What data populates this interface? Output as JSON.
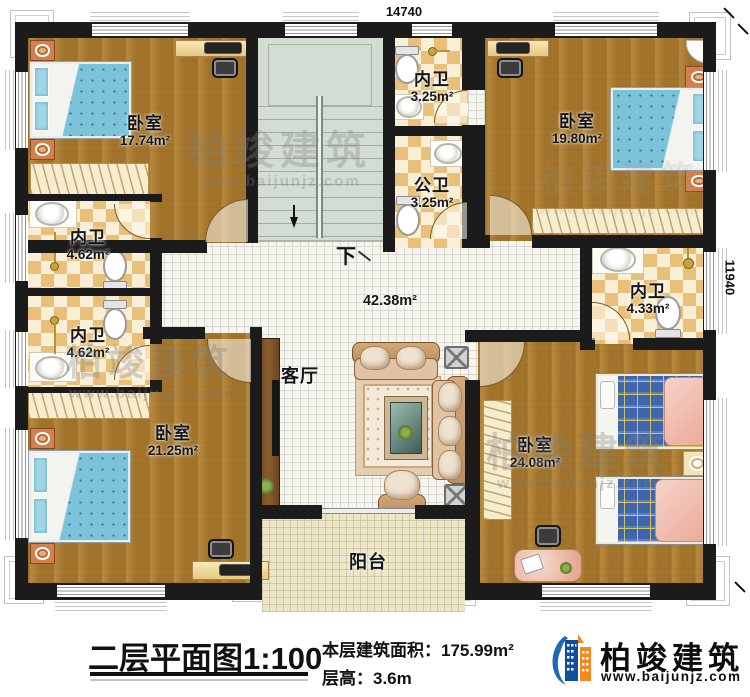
{
  "dimensions": {
    "top": "14740",
    "right": "11940"
  },
  "rooms": {
    "bedroom_tl": {
      "name": "卧室",
      "area": "17.74m²"
    },
    "bedroom_tr": {
      "name": "卧室",
      "area": "19.80m²"
    },
    "bedroom_bl": {
      "name": "卧室",
      "area": "21.25m²"
    },
    "bedroom_br": {
      "name": "卧室",
      "area": "24.08m²"
    },
    "bath_top": {
      "name": "内卫",
      "area": "3.25m²"
    },
    "bath_public": {
      "name": "公卫",
      "area": "3.25m²"
    },
    "bath_left1": {
      "name": "内卫",
      "area": "4.62m²"
    },
    "bath_left2": {
      "name": "内卫",
      "area": "4.62m²"
    },
    "bath_right": {
      "name": "内卫",
      "area": "4.33m²"
    },
    "living": {
      "name": "客厅",
      "area": "42.38m²"
    },
    "balcony": {
      "name": "阳台"
    },
    "stairs": {
      "label": "下"
    }
  },
  "footer": {
    "title": "二层平面图1:100",
    "area_line": "本层建筑面积：175.99m²",
    "height_line": "层高：3.6m"
  },
  "brand": {
    "name": "柏竣建筑",
    "url": "www.baijunjz.com"
  },
  "watermark": {
    "name": "柏竣建筑",
    "url": "www.baijunjz.com"
  },
  "colors": {
    "wall": "#1b1b1b",
    "wood": "#ad7c2e",
    "bath_tile": "#e8c07a",
    "living_tile": "#f6f6f1",
    "balcony_tile": "#ece6c9",
    "stairs": "#d4ddd3",
    "logo_blue": "#1a6ab8",
    "logo_orange": "#f28a1e"
  }
}
